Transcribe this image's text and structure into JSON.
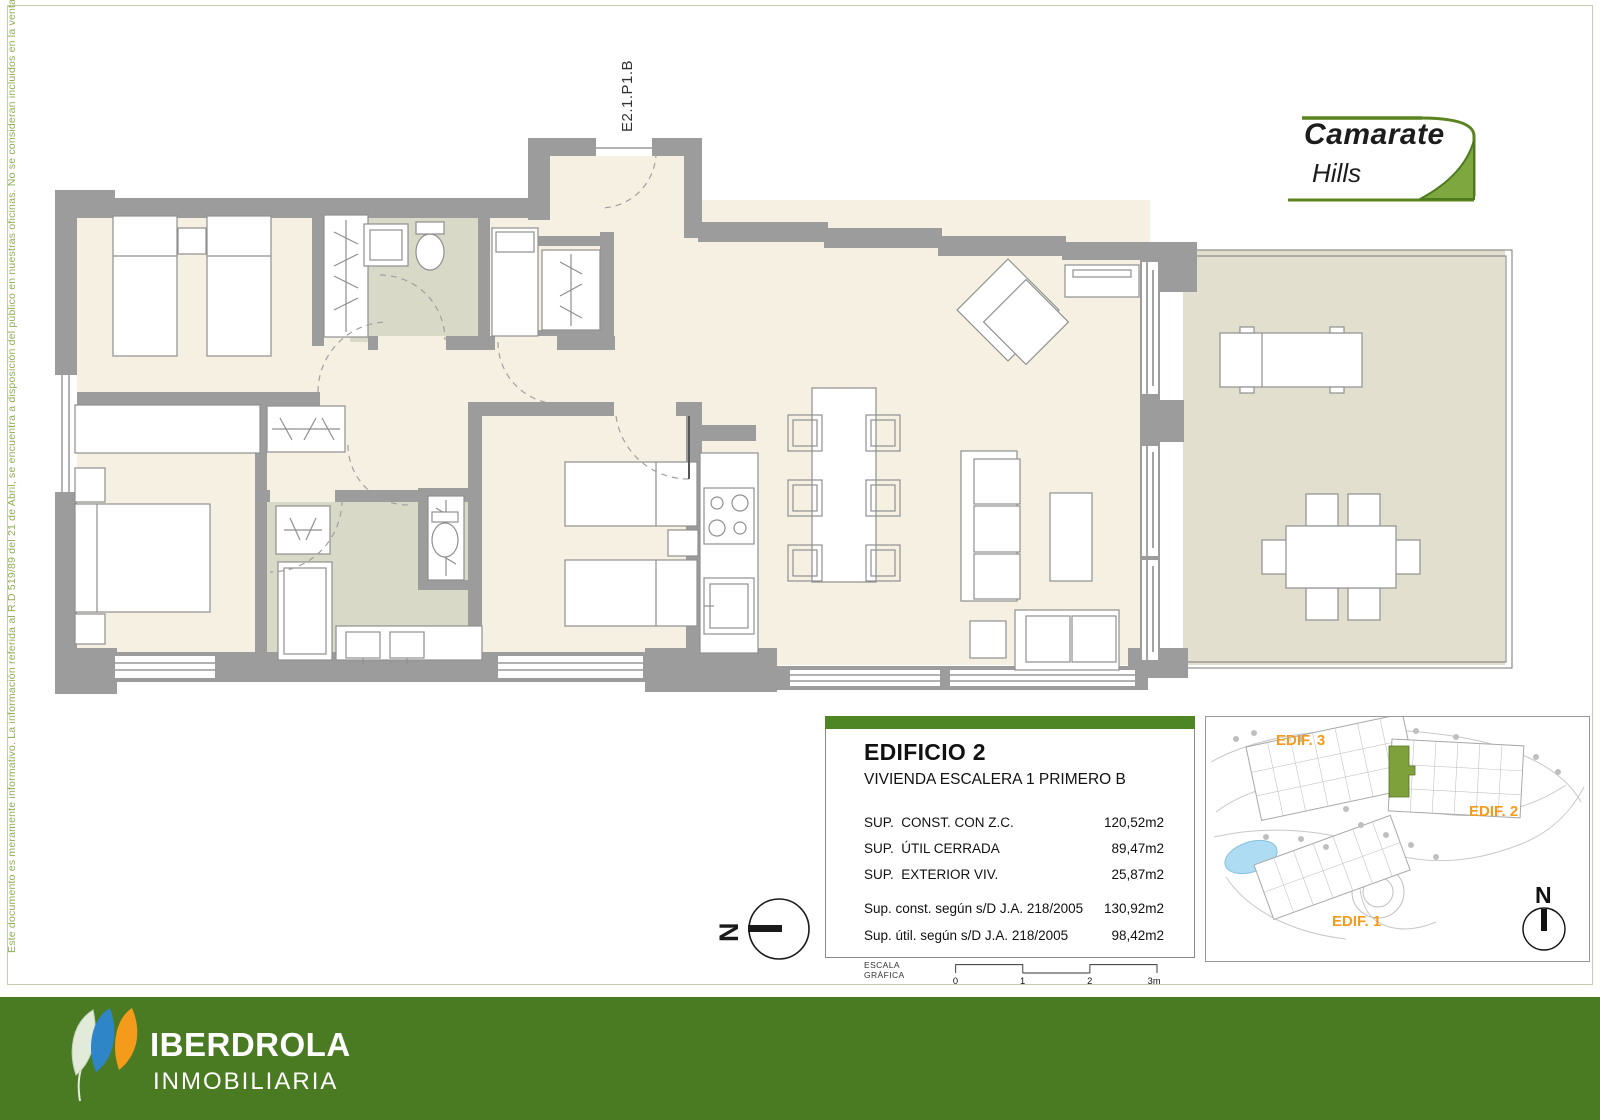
{
  "page": {
    "disclaimer": "Este documento es meramente informativo. La información referida al R.D 519/89 del 21 de Abril, se encuentra a disposición del público en nuestras oficinas. No se consideran incluidos en la venta del inmueble el mobiliario.",
    "unit_code": "E2.1.P1.B"
  },
  "logo": {
    "line1": "Camarate",
    "line2": "Hills"
  },
  "info_box": {
    "title": "EDIFICIO 2",
    "subtitle": "VIVIENDA ESCALERA 1 PRIMERO B",
    "rows": [
      {
        "label": "SUP.  CONST. CON Z.C.",
        "value": "120,52m2"
      },
      {
        "label": "SUP.  ÚTIL CERRADA",
        "value": "89,47m2"
      },
      {
        "label": "SUP.  EXTERIOR VIV.",
        "value": "25,87m2"
      }
    ],
    "rows_small": [
      {
        "label": "Sup. const. según s/D J.A. 218/2005",
        "value": "130,92m2"
      },
      {
        "label": "Sup. útil. según s/D J.A. 218/2005",
        "value": "98,42m2"
      }
    ],
    "scale_label": "ESCALA GRÁFICA",
    "ticks": [
      "0",
      "1",
      "2",
      "3m"
    ]
  },
  "site_plan": {
    "edif1": "EDIF. 1",
    "edif2": "EDIF. 2",
    "edif3": "EDIF. 3",
    "north": "N"
  },
  "compass": {
    "north": "N"
  },
  "footer": {
    "brand": "IBERDROLA",
    "division": "INMOBILIARIA"
  },
  "colors": {
    "accent_green": "#4E8626",
    "brand_green": "#4A7B22",
    "label_orange": "#F59B1C",
    "highlight_green": "#7FA13C",
    "wall_gray": "#9C9C9C"
  }
}
